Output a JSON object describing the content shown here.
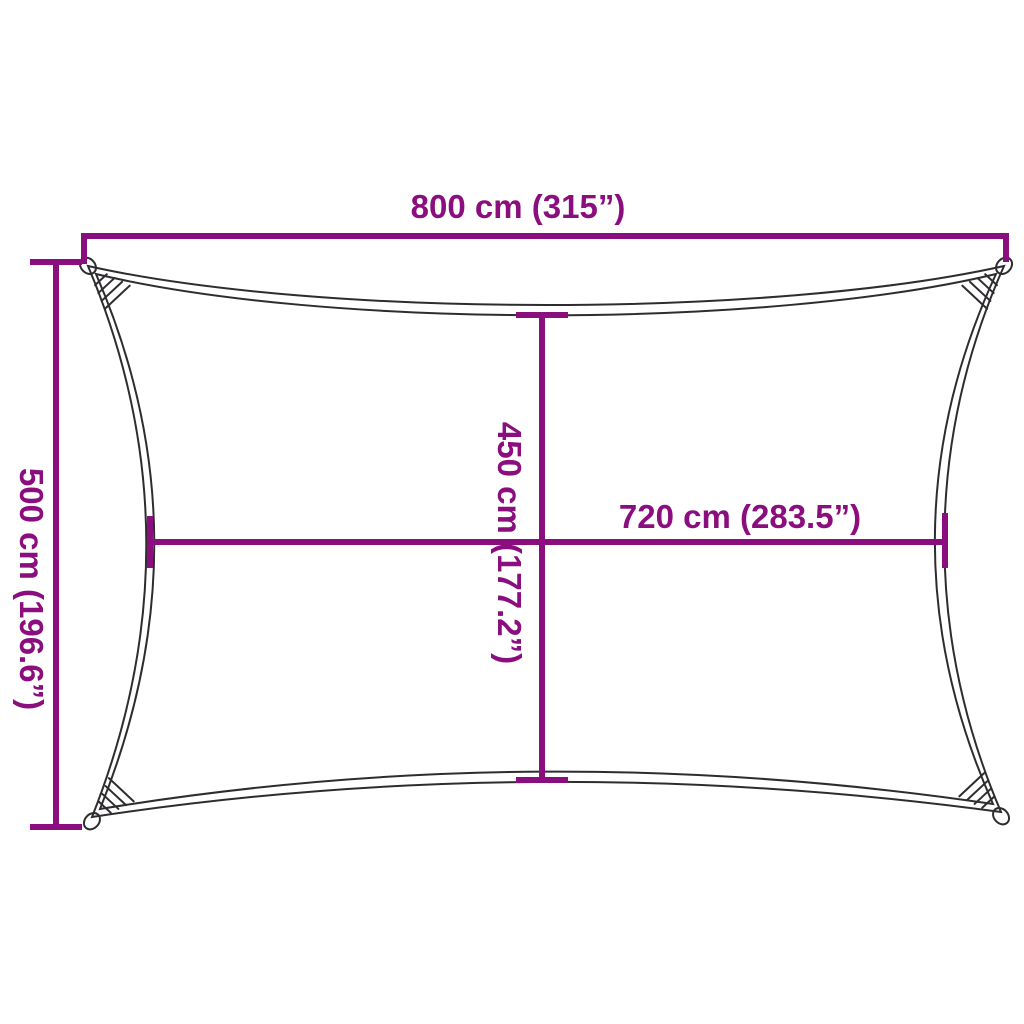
{
  "title": "Shade sail dimension diagram",
  "colors": {
    "dimension_line": "#8B0E7E",
    "sail_outline": "#2F2C2F",
    "background": "#FFFFFF"
  },
  "labels": {
    "width": "800 cm (315”)",
    "height": "500 cm (196.6”)",
    "inner_width": "720 cm (283.5”)",
    "inner_height": "450 cm (177.2”)"
  },
  "measurements": {
    "width_cm": 800,
    "width_in": 315,
    "height_cm": 500,
    "height_in": 196.6,
    "inner_width_cm": 720,
    "inner_width_in": 283.5,
    "inner_height_cm": 450,
    "inner_height_in": 177.2
  }
}
